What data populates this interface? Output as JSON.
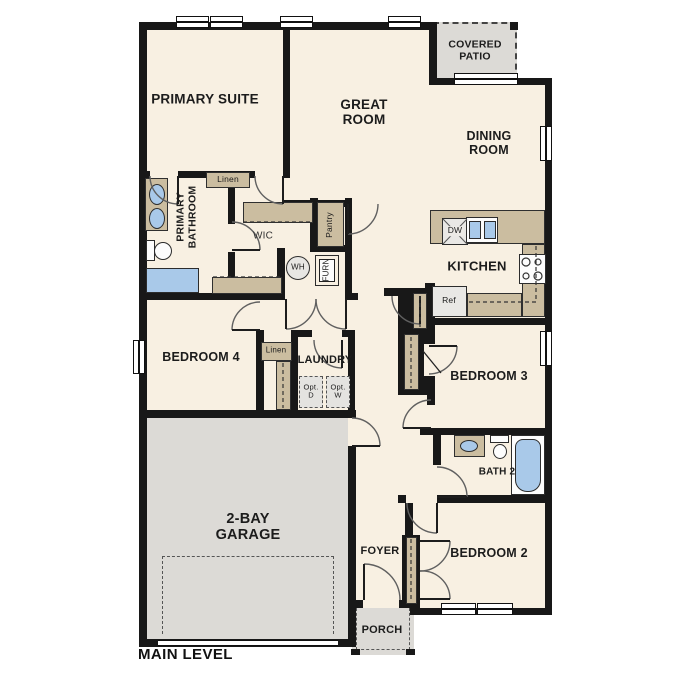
{
  "title": "MAIN LEVEL",
  "labels": {
    "primary_suite": "PRIMARY SUITE",
    "great_room": "GREAT ROOM",
    "covered_patio": "COVERED PATIO",
    "dining_room": "DINING ROOM",
    "kitchen": "KITCHEN",
    "primary_bathroom": "PRIMARY BATHROOM",
    "wic": "WIC",
    "pantry": "Pantry",
    "linen_primary": "Linen",
    "linen_hall": "Linen",
    "wh": "WH",
    "furn": "FURN",
    "dw": "DW",
    "ref": "Ref",
    "bedroom_4": "BEDROOM 4",
    "laundry": "LAUNDRY",
    "opt_dryer": "Opt. D",
    "opt_washer": "Opt. W",
    "bedroom_3": "BEDROOM 3",
    "bath_2": "BATH 2",
    "bedroom_2": "BEDROOM 2",
    "garage": "2-BAY GARAGE",
    "foyer": "FOYER",
    "porch": "PORCH"
  },
  "colors": {
    "floor": "#f8f0e2",
    "wall": "#181818",
    "casework_tan": "#cbbda0",
    "concrete_gray": "#dcdad6",
    "fixture_blue": "#a9c9e9",
    "appliance": "#e9e8e5"
  }
}
